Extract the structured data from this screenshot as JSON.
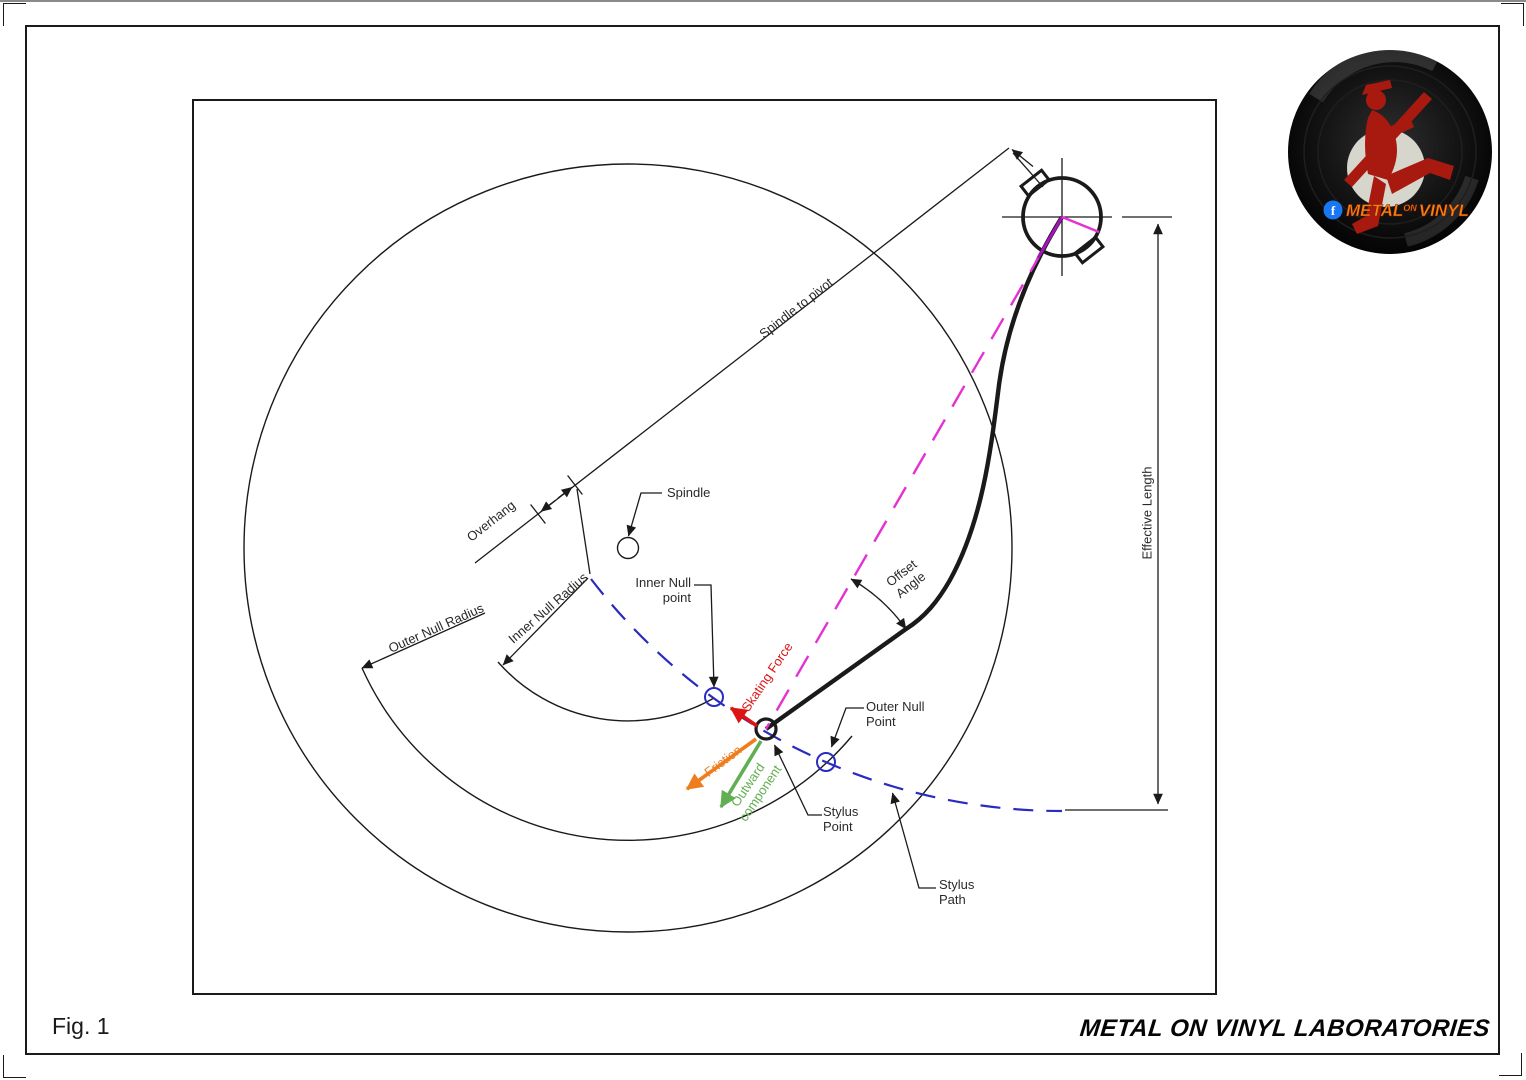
{
  "page": {
    "fig_label": "Fig. 1",
    "footer_brand": "METAL ON VINYL LABORATORIES"
  },
  "logo": {
    "brand_metal": "METAL",
    "brand_on": "ON",
    "brand_vinyl": "VINYL",
    "facebook_f": "f"
  },
  "diagram": {
    "labels": {
      "spindle_to_pivot": "Spindle to pivot",
      "overhang": "Overhang",
      "spindle": "Spindle",
      "inner_null_radius": "Inner Null Radius",
      "outer_null_radius": "Outer Null Radius",
      "inner_null_point": "Inner Null point",
      "outer_null_point": "Outer Null Point",
      "stylus_point": "Stylus Point",
      "stylus_path": "Stylus Path",
      "skating_force": "Skating Force",
      "friction": "Friction",
      "outward_component": "Outward component",
      "offset_angle": "Offset Angle",
      "effective_length": "Effective Length"
    },
    "colors": {
      "line": "#1a1a1a",
      "blue": "#2b2bbf",
      "magenta": "#e431d3",
      "purple": "#a512b8",
      "red": "#dd1414",
      "orange": "#ee7d1e",
      "green": "#62ae52",
      "logo_orange": "#f58312",
      "fb_blue": "#1877f2",
      "vinyl_red": "#a81a10"
    }
  }
}
